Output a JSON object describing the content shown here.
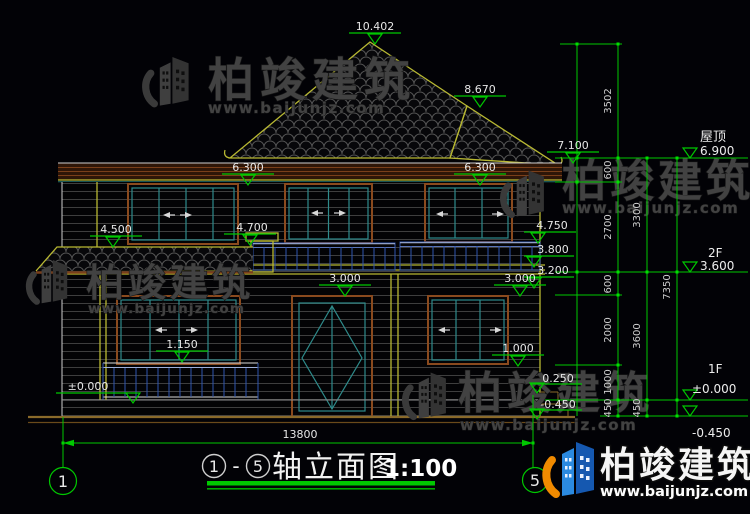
{
  "watermark": {
    "brand": "柏竣建筑",
    "url": "www.baijunjz.com"
  },
  "title": {
    "axis_start": "1",
    "separator": "-",
    "axis_end": "5",
    "name": "轴立面图",
    "scale": "1:100"
  },
  "axes": {
    "left": "1",
    "right": "5"
  },
  "levels": {
    "roof_label": "屋顶",
    "roof_value": "6.900",
    "f2_label": "2F",
    "f2_value": "3.600",
    "f1_label": "1F",
    "f1_value": "±0.000",
    "ground_value": "-0.450"
  },
  "marks": {
    "peak": "10.402",
    "ridge": "8.670",
    "right_eave": "7.100",
    "win2f_left": "6.300",
    "win2f_right": "6.300",
    "porch": "4.500",
    "rail2f_center": "4.700",
    "rail2f_right": "4.750",
    "slab": "3.800",
    "beam": "3.200",
    "door_top": "3.000",
    "win1f_right_top": "3.000",
    "rail1f": "1.150",
    "sill1f": "1.000",
    "floor1f": "±0.000",
    "platform": "0.250",
    "ground": "-0.450"
  },
  "dims": {
    "overall_width": "13800",
    "col1": [
      "3502",
      "600",
      "2700",
      "600",
      "2000",
      "1000",
      "450"
    ],
    "col2": [
      "3300",
      "3600",
      "450"
    ],
    "col3": [
      "7350"
    ]
  },
  "colors": {
    "dim_green": "#00c800",
    "roof_edge": "#b8b832",
    "window_teal": "#2e8b8b",
    "frame_brown": "#8a4a1e",
    "logo_blue": "#2b8ae0",
    "logo_orange": "#f08a00"
  }
}
